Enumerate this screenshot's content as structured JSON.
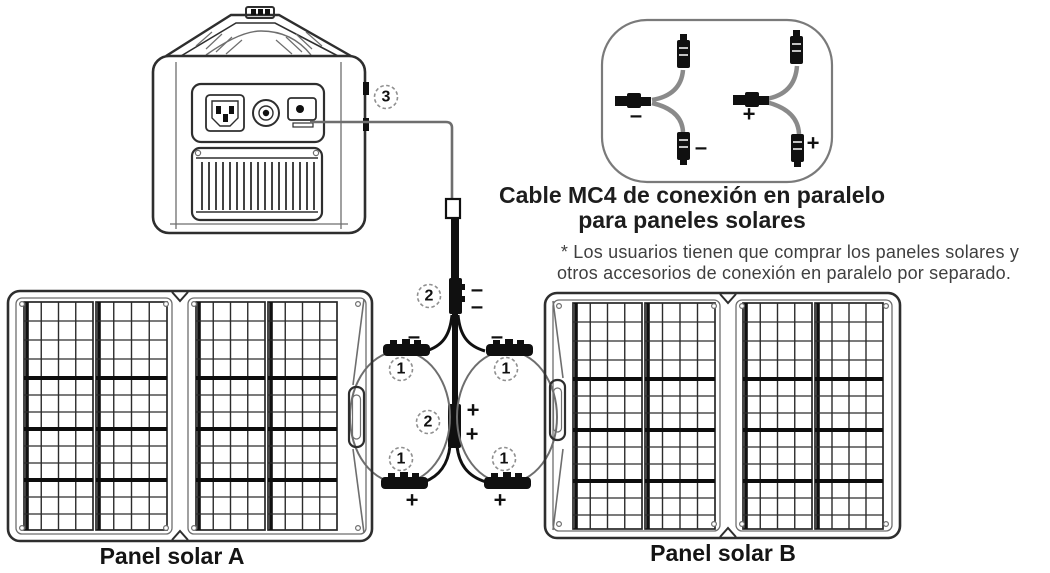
{
  "mc4_box": {
    "title_line1": "Cable MC4 de conexión en paralelo",
    "title_line2": "para paneles solares",
    "note_line1": "* Los usuarios tienen que comprar los paneles solares y",
    "note_line2": "otros accesorios de conexión en paralelo por separado."
  },
  "panels": {
    "panel_a_label": "Panel solar A",
    "panel_b_label": "Panel solar B"
  },
  "callouts": {
    "one": "1",
    "two": "2",
    "three": "3"
  },
  "signs": {
    "plus": "+",
    "minus": "–"
  },
  "colors": {
    "line_dark": "#2e2e2e",
    "line_gray": "#6e6e6e",
    "connector_black": "#101010",
    "title_text": "#1d1d1d",
    "note_text": "#3f3f3f",
    "background": "#ffffff"
  }
}
